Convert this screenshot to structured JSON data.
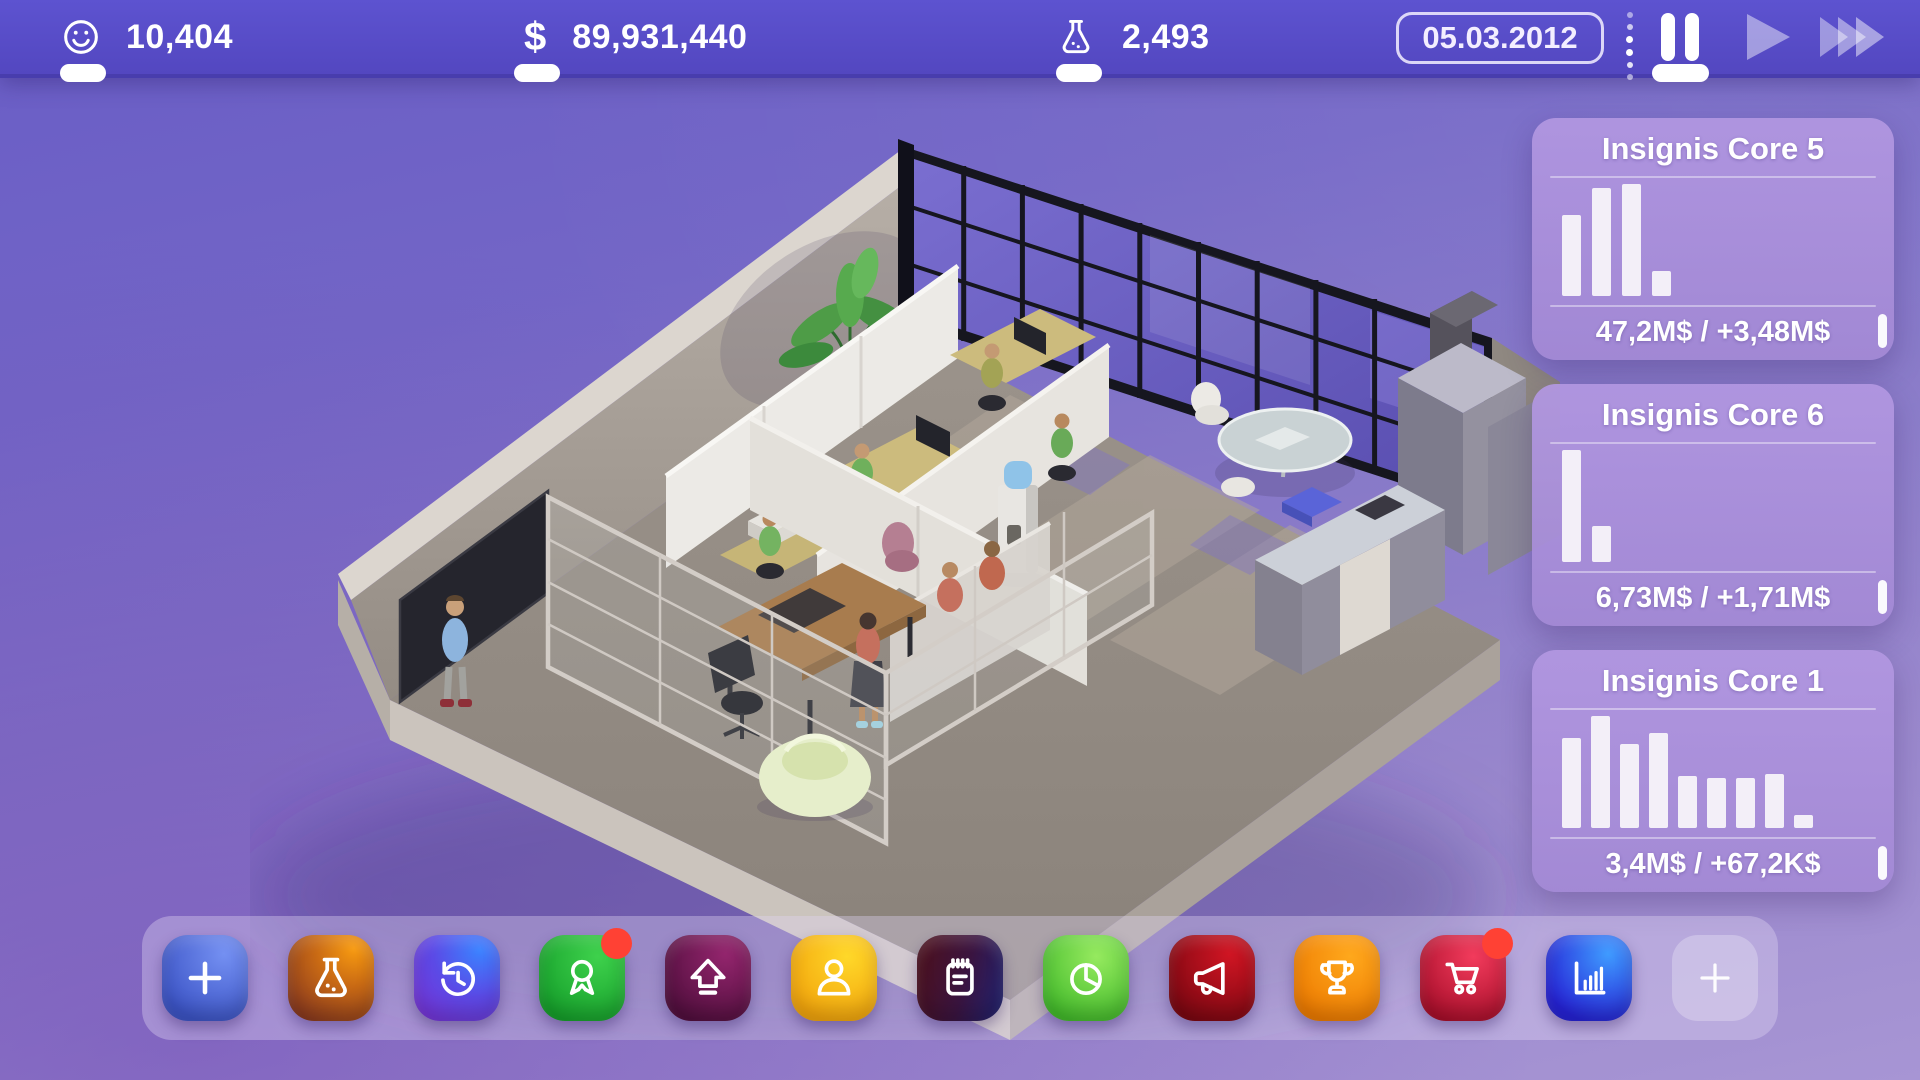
{
  "topbar": {
    "happiness": {
      "icon": "smiley-icon",
      "value": "10,404"
    },
    "money": {
      "icon": "dollar-icon",
      "symbol": "$",
      "value": "89,931,440"
    },
    "research": {
      "icon": "flask-icon",
      "value": "2,493"
    },
    "date": "05.03.2012",
    "speed": {
      "options": [
        "pause",
        "play",
        "fast-forward"
      ],
      "active": "pause"
    }
  },
  "products": {
    "cards": [
      {
        "name": "Insignis Core 5",
        "stats": "47,2M$ / +3,48M$",
        "bars": [
          0.72,
          0.96,
          1.0,
          0.22
        ]
      },
      {
        "name": "Insignis Core 6",
        "stats": "6,73M$ / +1,71M$",
        "bars": [
          1.0,
          0.32
        ]
      },
      {
        "name": "Insignis Core 1",
        "stats": "3,4M$ / +67,2K$",
        "bars": [
          0.8,
          1.0,
          0.75,
          0.85,
          0.46,
          0.45,
          0.45,
          0.48,
          0.12
        ]
      }
    ]
  },
  "toolbar": {
    "buttons": [
      {
        "name": "add",
        "icon": "plus-icon",
        "color": "#4a63d8",
        "badge": false
      },
      {
        "name": "research",
        "icon": "flask-icon",
        "color": "#c75a12",
        "badge": false
      },
      {
        "name": "history",
        "icon": "history-clock-icon",
        "color": "#6b3ae8",
        "badge": false
      },
      {
        "name": "achievements",
        "icon": "award-ribbon-icon",
        "color": "#23b336",
        "badge": true
      },
      {
        "name": "upgrade",
        "icon": "up-arrow-icon",
        "color": "#6e1054",
        "badge": false
      },
      {
        "name": "staff",
        "icon": "person-icon",
        "color": "#f7b313",
        "badge": false
      },
      {
        "name": "tasks",
        "icon": "notepad-icon",
        "color": "#35175c",
        "badge": false
      },
      {
        "name": "reports",
        "icon": "pie-chart-icon",
        "color": "#57c437",
        "badge": false
      },
      {
        "name": "marketing",
        "icon": "megaphone-icon",
        "color": "#98101c",
        "badge": false
      },
      {
        "name": "trophies",
        "icon": "trophy-icon",
        "color": "#f68d06",
        "badge": false
      },
      {
        "name": "shop",
        "icon": "cart-icon",
        "color": "#c81a3e",
        "badge": true
      },
      {
        "name": "statistics",
        "icon": "bar-chart-icon",
        "color": "#2448e8",
        "badge": false
      },
      {
        "name": "add-slot",
        "icon": "plus-icon",
        "color": "rgba(255,255,255,0.3)",
        "badge": false
      }
    ]
  },
  "colors": {
    "topbar": "#584ec6",
    "background_top": "#695dc6",
    "background_bottom": "#a795d4",
    "badge": "#ff4134",
    "card_bar": "#f3eff8"
  }
}
